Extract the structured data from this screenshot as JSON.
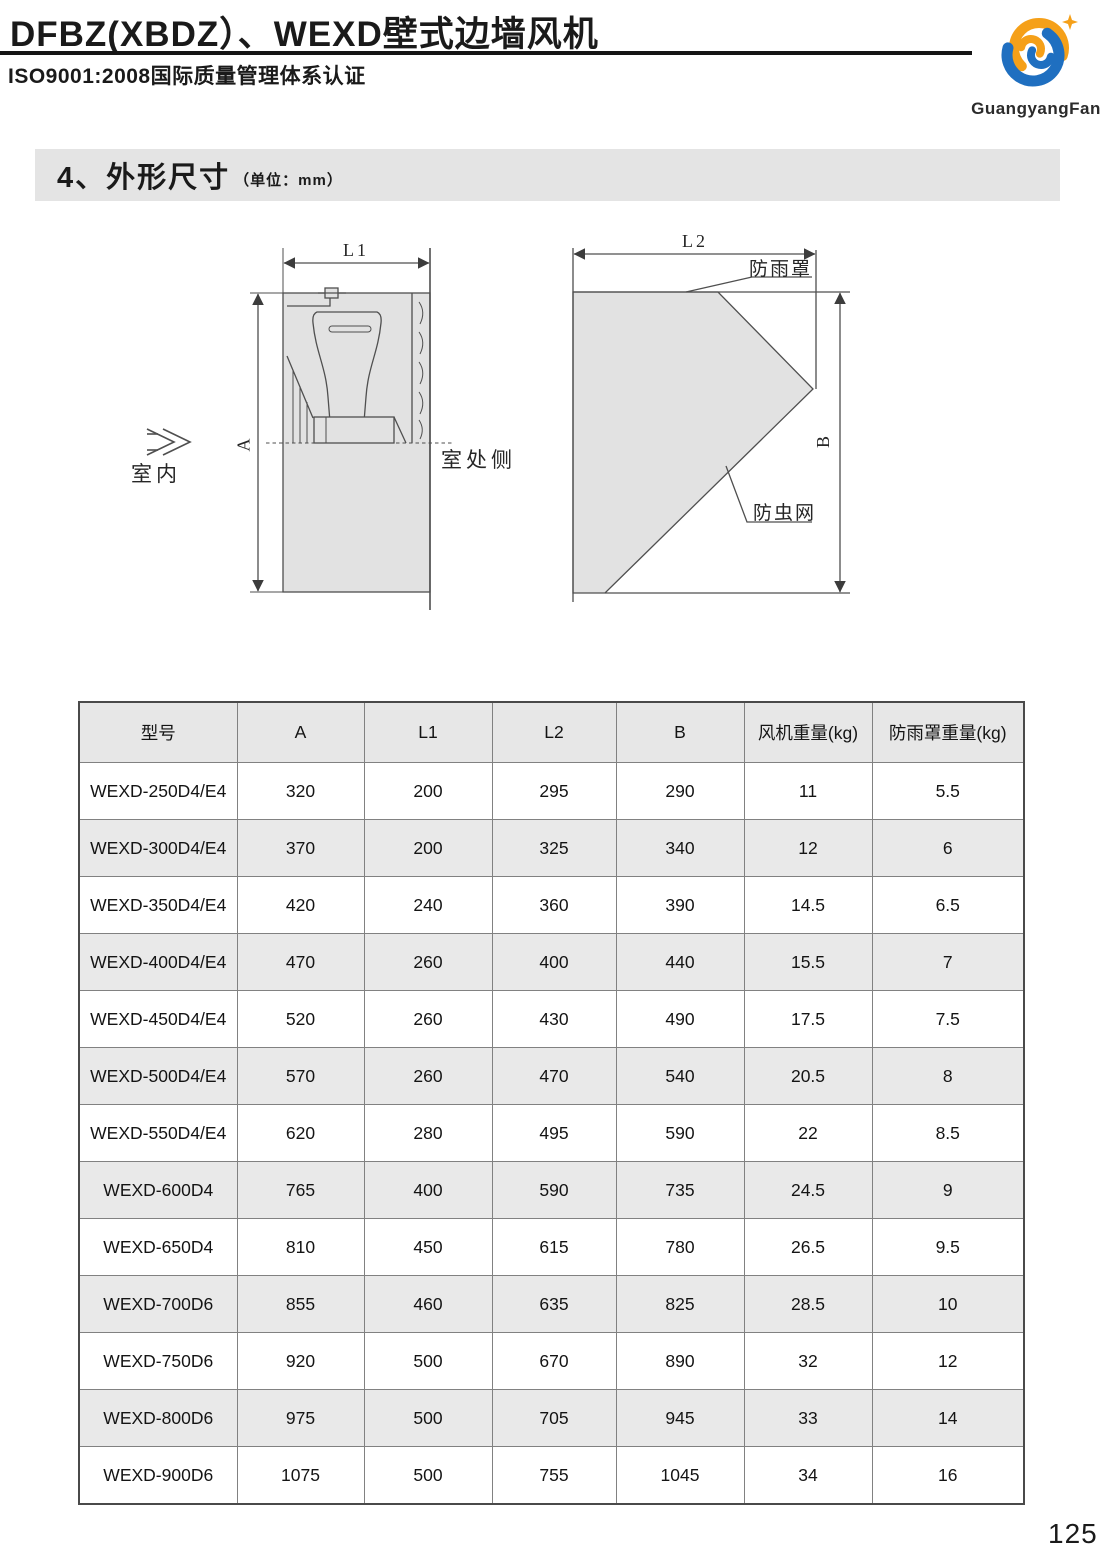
{
  "header": {
    "title": "DFBZ(XBDZ）、WEXD壁式边墙风机",
    "subtitle": "ISO9001:2008国际质量管理体系认证",
    "logo_text": "GuangyangFan",
    "logo_blue": "#1f6fc0",
    "logo_orange": "#f5a019"
  },
  "section": {
    "title": "4、外形尺寸",
    "unit_note": "（单位：mm）"
  },
  "diagram": {
    "l1": "L1",
    "l2": "L2",
    "a": "A",
    "b": "B",
    "indoor": "室内",
    "outdoor_side": "室处侧",
    "rain_cover": "防雨罩",
    "insect_net": "防虫网"
  },
  "table": {
    "headers": [
      "型号",
      "A",
      "L1",
      "L2",
      "B",
      "风机重量(kg)",
      "防雨罩重量(kg)"
    ],
    "rows": [
      [
        "WEXD-250D4/E4",
        "320",
        "200",
        "295",
        "290",
        "11",
        "5.5"
      ],
      [
        "WEXD-300D4/E4",
        "370",
        "200",
        "325",
        "340",
        "12",
        "6"
      ],
      [
        "WEXD-350D4/E4",
        "420",
        "240",
        "360",
        "390",
        "14.5",
        "6.5"
      ],
      [
        "WEXD-400D4/E4",
        "470",
        "260",
        "400",
        "440",
        "15.5",
        "7"
      ],
      [
        "WEXD-450D4/E4",
        "520",
        "260",
        "430",
        "490",
        "17.5",
        "7.5"
      ],
      [
        "WEXD-500D4/E4",
        "570",
        "260",
        "470",
        "540",
        "20.5",
        "8"
      ],
      [
        "WEXD-550D4/E4",
        "620",
        "280",
        "495",
        "590",
        "22",
        "8.5"
      ],
      [
        "WEXD-600D4",
        "765",
        "400",
        "590",
        "735",
        "24.5",
        "9"
      ],
      [
        "WEXD-650D4",
        "810",
        "450",
        "615",
        "780",
        "26.5",
        "9.5"
      ],
      [
        "WEXD-700D6",
        "855",
        "460",
        "635",
        "825",
        "28.5",
        "10"
      ],
      [
        "WEXD-750D6",
        "920",
        "500",
        "670",
        "890",
        "32",
        "12"
      ],
      [
        "WEXD-800D6",
        "975",
        "500",
        "705",
        "945",
        "33",
        "14"
      ],
      [
        "WEXD-900D6",
        "1075",
        "500",
        "755",
        "1045",
        "34",
        "16"
      ]
    ]
  },
  "page_number": "125"
}
